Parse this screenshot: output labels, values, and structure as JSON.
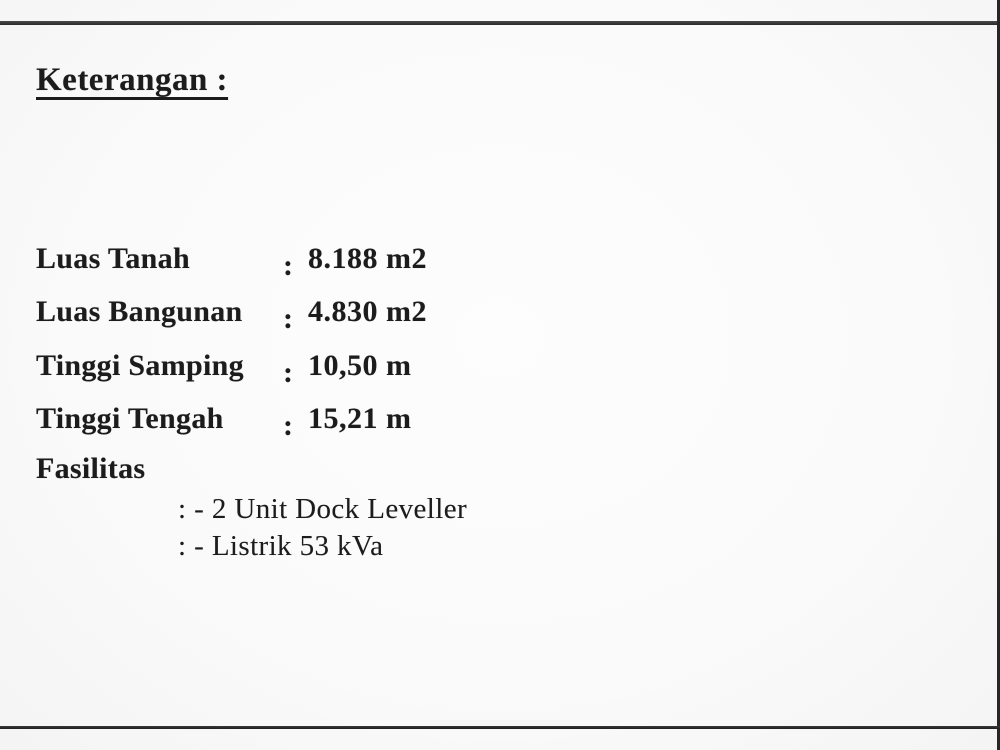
{
  "document": {
    "heading": "Keterangan :",
    "rows": [
      {
        "label": "Luas Tanah",
        "colon": ":",
        "value": "8.188 m2"
      },
      {
        "label": "Luas Bangunan",
        "colon": ":",
        "value": "4.830 m2"
      },
      {
        "label": "Tinggi Samping",
        "colon": ":",
        "value": "10,50 m"
      },
      {
        "label": "Tinggi Tengah",
        "colon": ":",
        "value": "15,21 m"
      }
    ],
    "facilities": {
      "label": "Fasilitas",
      "items": [
        {
          "text": ": - 2 Unit Dock Leveller"
        },
        {
          "text": ": - Listrik 53 kVa"
        }
      ]
    },
    "colors": {
      "text": "#1c1c1c",
      "background": "#fafafa",
      "border": "#2e2e2e"
    }
  }
}
